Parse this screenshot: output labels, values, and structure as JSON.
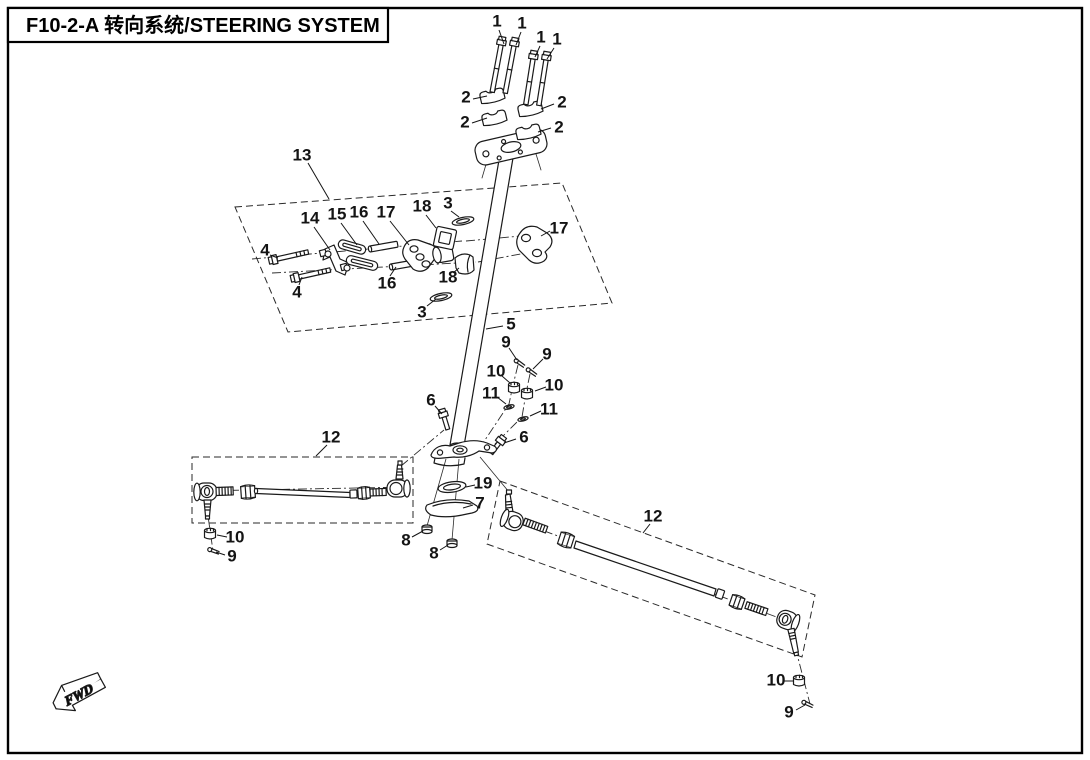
{
  "figure": {
    "code": "F10-2-A",
    "title_zh": "转向系统",
    "title_en": "STEERING SYSTEM",
    "title_display": "F10-2-A  转向系统/STEERING SYSTEM"
  },
  "fwd_marker": {
    "label": "FWD"
  },
  "callouts": [
    {
      "label": "1",
      "x": 497,
      "y": 21,
      "leader": [
        [
          499,
          30
        ],
        [
          504,
          44
        ]
      ]
    },
    {
      "label": "1",
      "x": 522,
      "y": 23,
      "leader": [
        [
          521,
          32
        ],
        [
          516,
          45
        ]
      ]
    },
    {
      "label": "1",
      "x": 541,
      "y": 37,
      "leader": [
        [
          540,
          46
        ],
        [
          535,
          57
        ]
      ]
    },
    {
      "label": "1",
      "x": 557,
      "y": 39,
      "leader": [
        [
          554,
          48
        ],
        [
          547,
          59
        ]
      ]
    },
    {
      "label": "2",
      "x": 466,
      "y": 97,
      "leader": [
        [
          473,
          99
        ],
        [
          487,
          96
        ]
      ]
    },
    {
      "label": "2",
      "x": 465,
      "y": 122,
      "leader": [
        [
          472,
          123
        ],
        [
          487,
          118
        ]
      ]
    },
    {
      "label": "2",
      "x": 562,
      "y": 102,
      "leader": [
        [
          554,
          104
        ],
        [
          541,
          109
        ]
      ]
    },
    {
      "label": "2",
      "x": 559,
      "y": 127,
      "leader": [
        [
          551,
          128
        ],
        [
          538,
          132
        ]
      ]
    },
    {
      "label": "13",
      "x": 302,
      "y": 155,
      "leader": [
        [
          308,
          163
        ],
        [
          329,
          199
        ]
      ]
    },
    {
      "label": "14",
      "x": 310,
      "y": 218,
      "leader": [
        [
          314,
          227
        ],
        [
          330,
          250
        ]
      ]
    },
    {
      "label": "15",
      "x": 337,
      "y": 214,
      "leader": [
        [
          341,
          223
        ],
        [
          357,
          245
        ]
      ]
    },
    {
      "label": "16",
      "x": 359,
      "y": 212,
      "leader": [
        [
          363,
          221
        ],
        [
          379,
          244
        ]
      ]
    },
    {
      "label": "17",
      "x": 386,
      "y": 212,
      "leader": [
        [
          390,
          221
        ],
        [
          409,
          245
        ]
      ]
    },
    {
      "label": "18",
      "x": 422,
      "y": 206,
      "leader": [
        [
          426,
          215
        ],
        [
          436,
          228
        ]
      ]
    },
    {
      "label": "3",
      "x": 448,
      "y": 203,
      "leader": [
        [
          451,
          211
        ],
        [
          459,
          217
        ]
      ]
    },
    {
      "label": "17",
      "x": 559,
      "y": 228,
      "leader": [
        [
          550,
          231
        ],
        [
          541,
          236
        ]
      ]
    },
    {
      "label": "4",
      "x": 265,
      "y": 250,
      "leader": [
        [
          270,
          255
        ],
        [
          278,
          258
        ]
      ]
    },
    {
      "label": "4",
      "x": 297,
      "y": 292,
      "leader": [
        [
          299,
          285
        ],
        [
          302,
          277
        ]
      ]
    },
    {
      "label": "16",
      "x": 387,
      "y": 283,
      "leader": [
        [
          390,
          276
        ],
        [
          396,
          267
        ]
      ]
    },
    {
      "label": "18",
      "x": 448,
      "y": 277,
      "leader": [
        [
          453,
          273
        ],
        [
          459,
          268
        ]
      ]
    },
    {
      "label": "3",
      "x": 422,
      "y": 312,
      "leader": [
        [
          427,
          306
        ],
        [
          436,
          299
        ]
      ]
    },
    {
      "label": "5",
      "x": 511,
      "y": 324,
      "leader": [
        [
          503,
          326
        ],
        [
          486,
          329
        ]
      ]
    },
    {
      "label": "9",
      "x": 506,
      "y": 342,
      "leader": [
        [
          509,
          348
        ],
        [
          517,
          360
        ]
      ]
    },
    {
      "label": "9",
      "x": 547,
      "y": 354,
      "leader": [
        [
          543,
          359
        ],
        [
          533,
          369
        ]
      ]
    },
    {
      "label": "10",
      "x": 496,
      "y": 371,
      "leader": [
        [
          502,
          376
        ],
        [
          510,
          383
        ]
      ]
    },
    {
      "label": "10",
      "x": 554,
      "y": 385,
      "leader": [
        [
          546,
          387
        ],
        [
          535,
          391
        ]
      ]
    },
    {
      "label": "11",
      "x": 491,
      "y": 393,
      "leader": [
        [
          497,
          397
        ],
        [
          506,
          404
        ]
      ]
    },
    {
      "label": "11",
      "x": 549,
      "y": 409,
      "leader": [
        [
          541,
          411
        ],
        [
          530,
          416
        ]
      ]
    },
    {
      "label": "6",
      "x": 431,
      "y": 400,
      "leader": [
        [
          435,
          406
        ],
        [
          442,
          414
        ]
      ]
    },
    {
      "label": "6",
      "x": 524,
      "y": 437,
      "leader": [
        [
          516,
          439
        ],
        [
          504,
          443
        ]
      ]
    },
    {
      "label": "19",
      "x": 483,
      "y": 483,
      "leader": [
        [
          475,
          485
        ],
        [
          466,
          487
        ]
      ]
    },
    {
      "label": "7",
      "x": 480,
      "y": 503,
      "leader": [
        [
          473,
          505
        ],
        [
          463,
          508
        ]
      ]
    },
    {
      "label": "8",
      "x": 406,
      "y": 540,
      "leader": [
        [
          412,
          537
        ],
        [
          423,
          531
        ]
      ]
    },
    {
      "label": "8",
      "x": 434,
      "y": 553,
      "leader": [
        [
          440,
          550
        ],
        [
          448,
          545
        ]
      ]
    },
    {
      "label": "12",
      "x": 331,
      "y": 437,
      "leader": [
        [
          327,
          445
        ],
        [
          316,
          456
        ]
      ]
    },
    {
      "label": "12",
      "x": 653,
      "y": 516,
      "leader": [
        [
          650,
          524
        ],
        [
          643,
          533
        ]
      ]
    },
    {
      "label": "10",
      "x": 235,
      "y": 537,
      "leader": [
        [
          227,
          537
        ],
        [
          217,
          535
        ]
      ]
    },
    {
      "label": "9",
      "x": 232,
      "y": 556,
      "leader": [
        [
          225,
          555
        ],
        [
          216,
          552
        ]
      ]
    },
    {
      "label": "10",
      "x": 776,
      "y": 680,
      "leader": [
        [
          784,
          681
        ],
        [
          794,
          681
        ]
      ]
    },
    {
      "label": "9",
      "x": 789,
      "y": 712,
      "leader": [
        [
          796,
          710
        ],
        [
          805,
          705
        ]
      ]
    }
  ]
}
